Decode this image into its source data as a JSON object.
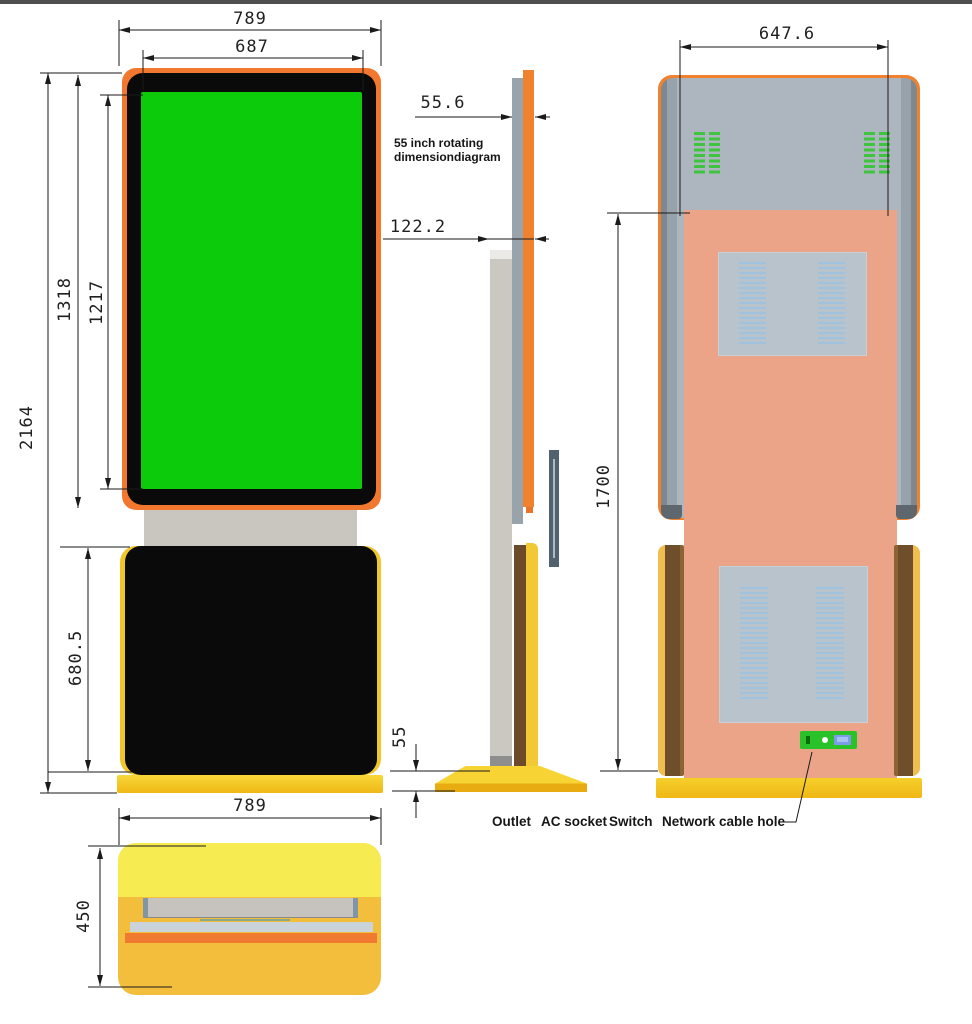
{
  "diagram": {
    "title_line1": "55 inch rotating",
    "title_line2": "dimensiondiagram",
    "front_view": {
      "overall_width": "789",
      "screen_width": "687",
      "overall_height": "2164",
      "screen_frame_height": "1318",
      "screen_visible_height": "1217",
      "cabinet_height": "680.5"
    },
    "side_view": {
      "screen_thickness": "55.6",
      "screen_and_column_depth": "122.2",
      "base_height": "55"
    },
    "back_view": {
      "back_width": "647.6",
      "body_height": "1700"
    },
    "bottom_view": {
      "base_width": "789",
      "base_depth": "450"
    },
    "callouts": {
      "outlet": "Outlet",
      "ac_socket": "AC socket",
      "switch_label": "Switch",
      "network_cable_hole": "Network cable hole"
    },
    "colors": {
      "screen_green": "#0BCB0B",
      "frame_orange": "#F2782F",
      "cabinet_black": "#0A0A0A",
      "accent_yellow": "#F2C21D",
      "back_salmon": "#ECA489",
      "back_gray": "#ADB6BE",
      "vent_green": "#3EC43E",
      "connector_panel_green": "#29C229",
      "dimension_line": "#1A1A1A"
    }
  }
}
